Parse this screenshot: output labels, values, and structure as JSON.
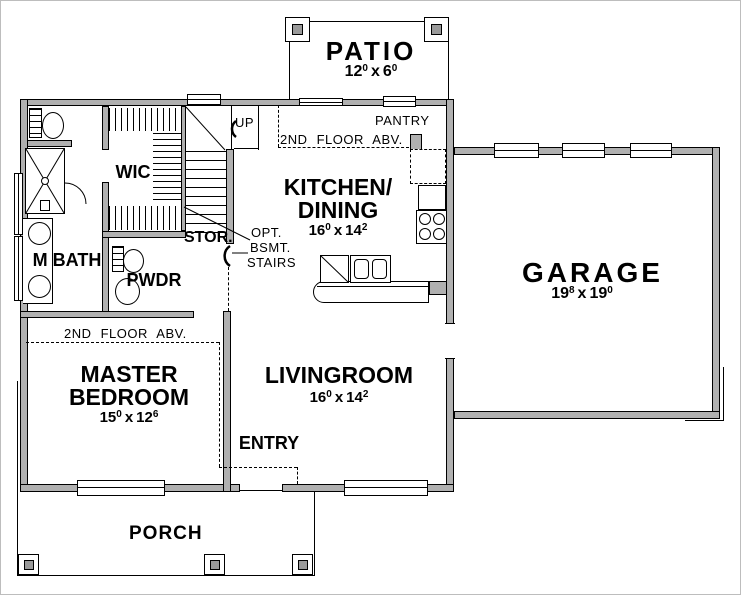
{
  "rooms": {
    "patio": {
      "name": "PATIO",
      "dim": {
        "a": "12",
        "as": "0",
        "sep": "x",
        "b": "6",
        "bs": "0"
      }
    },
    "kitchen": {
      "name_line1": "KITCHEN/",
      "name_line2": "DINING",
      "dim": {
        "a": "16",
        "as": "0",
        "sep": "x",
        "b": "14",
        "bs": "2"
      }
    },
    "garage": {
      "name": "GARAGE",
      "dim": {
        "a": "19",
        "as": "8",
        "sep": "x",
        "b": "19",
        "bs": "0"
      }
    },
    "master_bedroom": {
      "name_line1": "MASTER",
      "name_line2": "BEDROOM",
      "dim": {
        "a": "15",
        "as": "0",
        "sep": "x",
        "b": "12",
        "bs": "6"
      }
    },
    "livingroom": {
      "name": "LIVINGROOM",
      "dim": {
        "a": "16",
        "as": "0",
        "sep": "x",
        "b": "14",
        "bs": "2"
      }
    },
    "porch": {
      "name": "PORCH"
    },
    "master_bath": {
      "name": "M BATH"
    },
    "wic": {
      "name": "WIC"
    },
    "powder": {
      "name": "PWDR"
    },
    "storage": {
      "name": "STOR."
    },
    "entry": {
      "name": "ENTRY"
    },
    "pantry": {
      "name": "PANTRY"
    }
  },
  "annotations": {
    "up": "UP",
    "second_floor_above_kitchen": "2ND FLOOR ABV.",
    "second_floor_above_bedroom": "2ND FLOOR ABV.",
    "optional_basement_stairs": {
      "line1": "OPT.",
      "line2": "BSMT.",
      "line3": "STAIRS"
    }
  },
  "colors": {
    "wall_fill": "#b0b0b0",
    "line": "#000000",
    "background": "#ffffff",
    "post_fill": "#9a9a9a"
  }
}
